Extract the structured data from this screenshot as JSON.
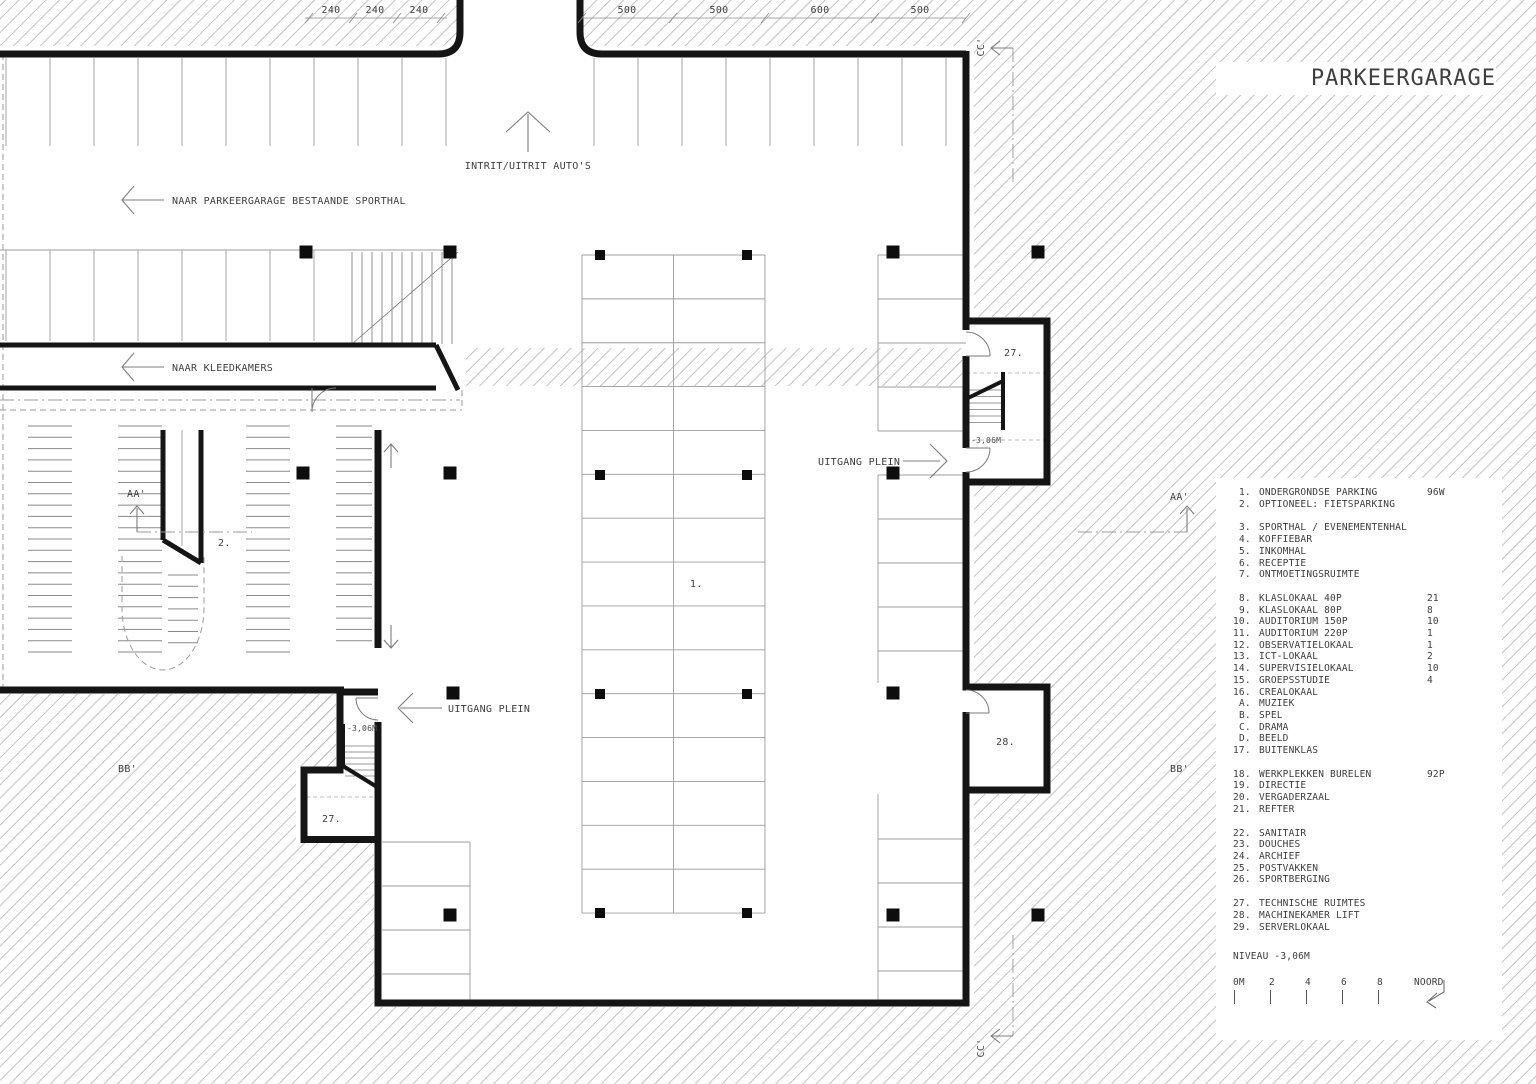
{
  "title": "PARKEERGARAGE",
  "plan": {
    "entrance_label": "INTRIT/UITRIT AUTO'S",
    "to_sporthal_label": "NAAR PARKEERGARAGE BESTAANDE SPORTHAL",
    "to_kleedkamers_label": "NAAR KLEEDKAMERS",
    "uitgang_right_label": "UITGANG PLEIN",
    "uitgang_left_label": "UITGANG PLEIN",
    "room_labels": {
      "parking": "1.",
      "fietsparking": "2.",
      "stair_right": "27.",
      "stair_left": "27.",
      "machine_room": "28."
    },
    "level_labels": {
      "stair_right": "-3,06M",
      "stair_left": "-3,06M"
    },
    "section_markers": {
      "aa_left": "AA'",
      "aa_right": "AA'",
      "bb_left": "BB'",
      "bb_right": "BB'",
      "cc_top": "CC'",
      "cc_bottom": "CC'"
    },
    "dims_left": [
      "240",
      "240",
      "240"
    ],
    "dims_right": [
      "500",
      "500",
      "600",
      "500"
    ]
  },
  "legend": {
    "groups": [
      [
        {
          "num": "1.",
          "label": "ONDERGRONDSE PARKING",
          "value": "96W"
        },
        {
          "num": "2.",
          "label": "OPTIONEEL: FIETSPARKING",
          "value": ""
        }
      ],
      [
        {
          "num": "3.",
          "label": "SPORTHAL / EVENEMENTENHAL",
          "value": ""
        },
        {
          "num": "4.",
          "label": "KOFFIEBAR",
          "value": ""
        },
        {
          "num": "5.",
          "label": "INKOMHAL",
          "value": ""
        },
        {
          "num": "6.",
          "label": "RECEPTIE",
          "value": ""
        },
        {
          "num": "7.",
          "label": "ONTMOETINGSRUIMTE",
          "value": ""
        }
      ],
      [
        {
          "num": "8.",
          "label": "KLASLOKAAL 40P",
          "value": "21"
        },
        {
          "num": "9.",
          "label": "KLASLOKAAL 80P",
          "value": "8"
        },
        {
          "num": "10.",
          "label": "AUDITORIUM 150P",
          "value": "10"
        },
        {
          "num": "11.",
          "label": "AUDITORIUM 220P",
          "value": "1"
        },
        {
          "num": "12.",
          "label": "OBSERVATIELOKAAL",
          "value": "1"
        },
        {
          "num": "13.",
          "label": "ICT-LOKAAL",
          "value": "2"
        },
        {
          "num": "14.",
          "label": "SUPERVISIELOKAAL",
          "value": "10"
        },
        {
          "num": "15.",
          "label": "GROEPSSTUDIE",
          "value": "4"
        },
        {
          "num": "16.",
          "label": "CREALOKAAL",
          "value": ""
        },
        {
          "num": "A.",
          "label": "MUZIEK",
          "value": ""
        },
        {
          "num": "B.",
          "label": "SPEL",
          "value": ""
        },
        {
          "num": "C.",
          "label": "DRAMA",
          "value": ""
        },
        {
          "num": "D.",
          "label": "BEELD",
          "value": ""
        },
        {
          "num": "17.",
          "label": "BUITENKLAS",
          "value": ""
        }
      ],
      [
        {
          "num": "18.",
          "label": "WERKPLEKKEN BURELEN",
          "value": "92P"
        },
        {
          "num": "19.",
          "label": "DIRECTIE",
          "value": ""
        },
        {
          "num": "20.",
          "label": "VERGADERZAAL",
          "value": ""
        },
        {
          "num": "21.",
          "label": "REFTER",
          "value": ""
        }
      ],
      [
        {
          "num": "22.",
          "label": "SANITAIR",
          "value": ""
        },
        {
          "num": "23.",
          "label": "DOUCHES",
          "value": ""
        },
        {
          "num": "24.",
          "label": "ARCHIEF",
          "value": ""
        },
        {
          "num": "25.",
          "label": "POSTVAKKEN",
          "value": ""
        },
        {
          "num": "26.",
          "label": "SPORTBERGING",
          "value": ""
        }
      ],
      [
        {
          "num": "27.",
          "label": "TECHNISCHE RUIMTES",
          "value": ""
        },
        {
          "num": "28.",
          "label": "MACHINEKAMER LIFT",
          "value": ""
        },
        {
          "num": "29.",
          "label": "SERVERLOKAAL",
          "value": ""
        }
      ]
    ],
    "niveau_label": "NIVEAU -3,06M",
    "scale": {
      "ticks": [
        "0M",
        "2",
        "4",
        "6",
        "8"
      ],
      "north_label": "NOORD"
    }
  },
  "colors": {
    "wall": "#151515",
    "hatch_line": "#b3b3b3",
    "stall_line": "#9c9c9c",
    "text": "#3d3d3d"
  }
}
